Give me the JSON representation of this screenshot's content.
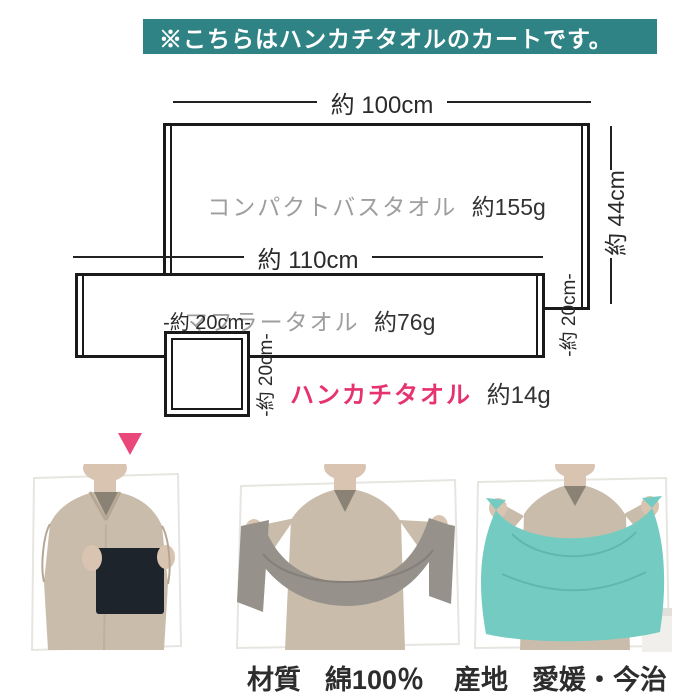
{
  "banner": {
    "text": "※こちらはハンカチタオルのカートです。",
    "bg_color": "#2F8385",
    "text_color": "#FFFFFF"
  },
  "diagram": {
    "line_color": "#1A1A1A",
    "label_gray": "#9E9E9E",
    "accent_pink": "#E6326E",
    "arrow_color": "#EA477B",
    "items": [
      {
        "id": "compact-bath-towel",
        "name": "コンパクトバスタオル",
        "weight": "約155g",
        "width_label": "約 100cm",
        "height_label": "約 44cm"
      },
      {
        "id": "muffler-towel",
        "name": "マフラータオル",
        "weight": "約76g",
        "width_label": "約 110cm",
        "height_label": "-約 20cm-"
      },
      {
        "id": "handkerchief-towel",
        "name": "ハンカチタオル",
        "weight": "約14g",
        "width_label": "-約 20cm-",
        "height_label": "-約 20cm-"
      }
    ]
  },
  "photos": [
    {
      "id": "photo-handkerchief-towel",
      "towel_color": "#1E242B"
    },
    {
      "id": "photo-muffler-towel",
      "towel_color": "#96918B"
    },
    {
      "id": "photo-compact-bath-towel",
      "towel_color": "#74CBC1"
    }
  ],
  "photo_palette": {
    "shirt": "#C9BCAB",
    "shirt_shadow": "#B5A794",
    "skin": "#D9C4B1",
    "inner_shirt": "#8A8274",
    "cutout_edge": "#E7E5E0"
  },
  "footer": {
    "items": [
      {
        "label": "材質",
        "value": "綿100％"
      },
      {
        "label": "産地",
        "value": "愛媛・今治"
      }
    ]
  }
}
